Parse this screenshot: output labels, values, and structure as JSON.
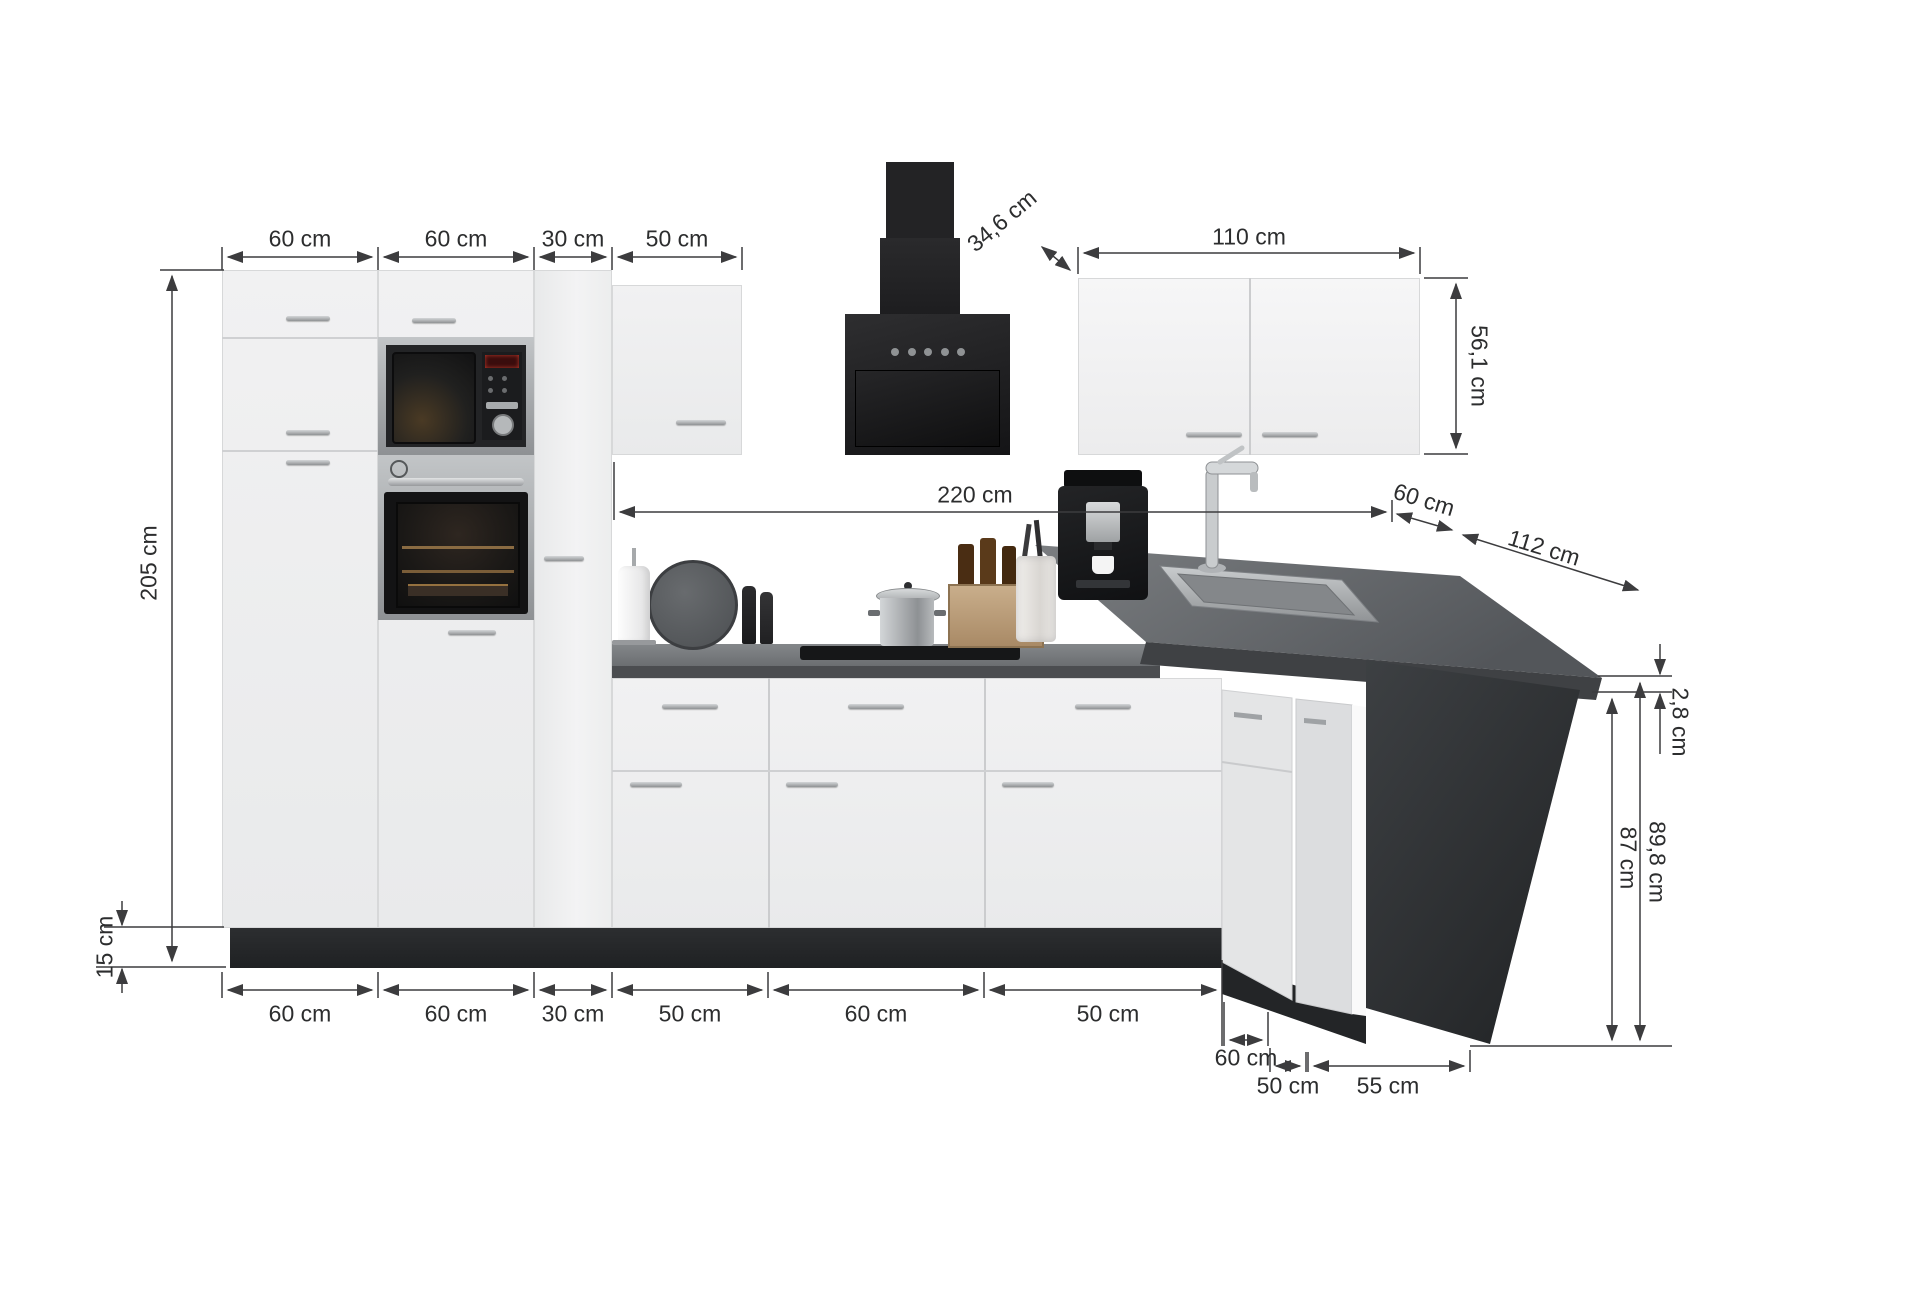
{
  "diagram": {
    "type": "kitchen-dimension-diagram",
    "unit": "cm",
    "colors": {
      "background": "#ffffff",
      "cabinet_front": "#f0f0f1",
      "worktop": "#57595c",
      "plinth": "#232527",
      "appliance_black": "#1b1b1d",
      "stainless": "#a8abae",
      "dimension_line": "#3c3c3e"
    },
    "dims": {
      "top": [
        "60 cm",
        "60 cm",
        "30 cm",
        "50 cm"
      ],
      "hood_depth": "34,6 cm",
      "right_wall_width": "110 cm",
      "right_wall_height": "56,1 cm",
      "tall_height": "205 cm",
      "plinth_height": "15 cm",
      "wall_run_width": "220 cm",
      "counter_depth": "60 cm",
      "return_depth": "112 cm",
      "worktop_thickness": "2,8 cm",
      "worktop_underside_height": "87 cm",
      "worktop_total_height": "89,8 cm",
      "bottom": [
        "60 cm",
        "60 cm",
        "30 cm",
        "50 cm",
        "60 cm",
        "50 cm"
      ],
      "corner_width": "60 cm",
      "return_bottom_50": "50 cm",
      "return_bottom_55": "55 cm"
    }
  }
}
